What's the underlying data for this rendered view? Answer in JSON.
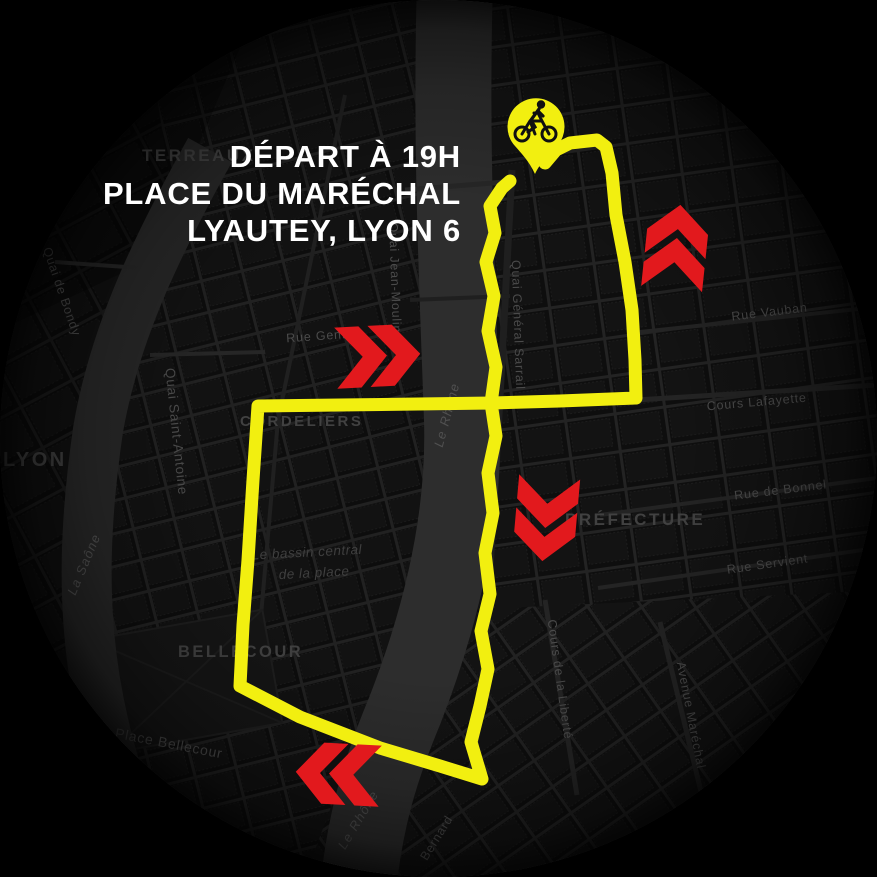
{
  "title": {
    "lines": [
      "DÉPART À 19H",
      "PLACE DU MARÉCHAL",
      "LYAUTEY, LYON 6"
    ]
  },
  "marker": {
    "icon": "bicycle",
    "meaning": "départ"
  },
  "chevrons": [
    {
      "direction": "right"
    },
    {
      "direction": "up"
    },
    {
      "direction": "down"
    },
    {
      "direction": "left"
    }
  ],
  "districts": [
    {
      "label": "TERREAUX"
    },
    {
      "label": "LYON"
    },
    {
      "label": "CORDELIERS"
    },
    {
      "label": "BELLECOUR"
    },
    {
      "label": "PRÉFECTURE"
    }
  ],
  "streets": [
    {
      "label": "Rue Vauban"
    },
    {
      "label": "Cours Lafayette"
    },
    {
      "label": "Rue de Bonnel"
    },
    {
      "label": "Rue Servient"
    },
    {
      "label": "Rue Gentil"
    },
    {
      "label": "Quai Saint-Antoine"
    },
    {
      "label": "Quai de Bondy"
    },
    {
      "label": "Quai Jean-Moulin"
    },
    {
      "label": "Quai Général Sarrail"
    },
    {
      "label": "Cours de la Liberté"
    },
    {
      "label": "Avenue Maréchal"
    },
    {
      "label": "Place Bellecour"
    },
    {
      "label": "Bernard"
    }
  ],
  "water": {
    "rivers": [
      {
        "label": "La Saône"
      },
      {
        "label": "Le Rhône"
      },
      {
        "label": "Le Rhône"
      }
    ],
    "basin": {
      "line1": "Le bassin central",
      "line2": "de la place"
    }
  },
  "colors": {
    "route": "#f2ef10",
    "pin": "#f2ef10",
    "chevron": "#e2191d",
    "map_background": "#0d0d0d",
    "outside": "#000000",
    "river": "#2d2d2d",
    "district_label": "#414141",
    "street_label": "#4b4b4b",
    "title_text": "#ffffff"
  }
}
